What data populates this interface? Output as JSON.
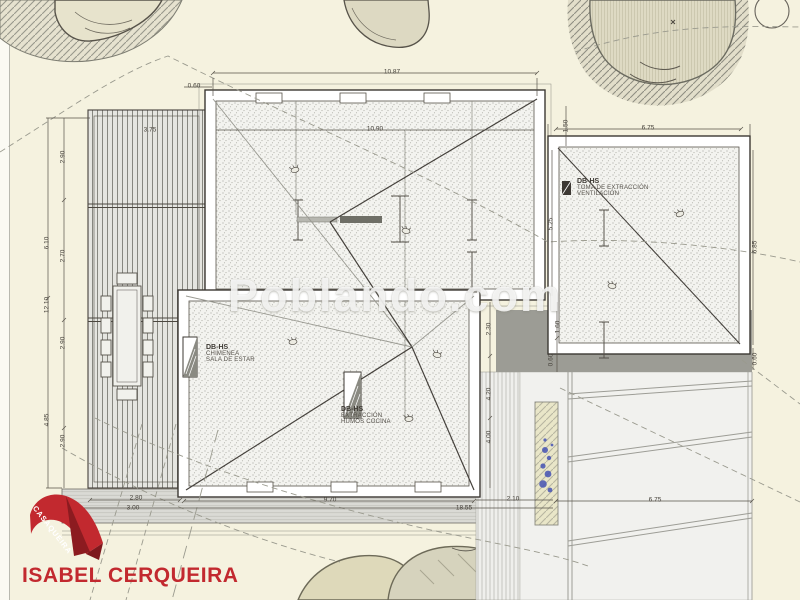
{
  "watermark": "Poblando.com",
  "logo": {
    "ribbon_text": "CASAQUEIRA",
    "name": "ISABEL CERQUEIRA",
    "red": "#c2292f"
  },
  "notes": {
    "intake": {
      "code": "DB-HS",
      "line1": "TOMA DE EXTRACCIÓN",
      "line2": "VENTILACIÓN"
    },
    "chimney": {
      "code": "DB-HS",
      "line1": "CHIMENEA",
      "line2": "SALA DE ESTAR"
    },
    "kitchen": {
      "code": "DB-HS",
      "line1": "EXTRACCIÓN",
      "line2": "HUMOS COCINA"
    }
  },
  "dimensions": [
    {
      "label": "0.60",
      "x": 194,
      "y": 86,
      "rot": 0
    },
    {
      "label": "10.87",
      "x": 392,
      "y": 72,
      "rot": 0
    },
    {
      "label": "10.90",
      "x": 375,
      "y": 129,
      "rot": 0
    },
    {
      "label": "6.75",
      "x": 648,
      "y": 128,
      "rot": 0
    },
    {
      "label": "1.50",
      "x": 566,
      "y": 126,
      "rot": -90
    },
    {
      "label": "5.25",
      "x": 551,
      "y": 224,
      "rot": -90
    },
    {
      "label": "6.85",
      "x": 755,
      "y": 247,
      "rot": -90
    },
    {
      "label": "0.60",
      "x": 755,
      "y": 359,
      "rot": -90
    },
    {
      "label": "3.75",
      "x": 150,
      "y": 130,
      "rot": 0
    },
    {
      "label": "2.90",
      "x": 63,
      "y": 157,
      "rot": -90
    },
    {
      "label": "6.10",
      "x": 47,
      "y": 243,
      "rot": -90
    },
    {
      "label": "2.70",
      "x": 63,
      "y": 256,
      "rot": -90
    },
    {
      "label": "12.10",
      "x": 47,
      "y": 305,
      "rot": -90
    },
    {
      "label": "2.90",
      "x": 63,
      "y": 343,
      "rot": -90
    },
    {
      "label": "4.85",
      "x": 47,
      "y": 420,
      "rot": -90
    },
    {
      "label": "2.90",
      "x": 63,
      "y": 441,
      "rot": -90
    },
    {
      "label": "2.30",
      "x": 489,
      "y": 329,
      "rot": -90
    },
    {
      "label": "1.60",
      "x": 558,
      "y": 327,
      "rot": -90
    },
    {
      "label": "0.60",
      "x": 551,
      "y": 360,
      "rot": -90
    },
    {
      "label": "4.20",
      "x": 489,
      "y": 394,
      "rot": -90
    },
    {
      "label": "4.00",
      "x": 489,
      "y": 437,
      "rot": -90
    },
    {
      "label": "2.80",
      "x": 136,
      "y": 498,
      "rot": 0
    },
    {
      "label": "3.00",
      "x": 133,
      "y": 508,
      "rot": 0
    },
    {
      "label": "9.70",
      "x": 330,
      "y": 500,
      "rot": 0
    },
    {
      "label": "18.55",
      "x": 464,
      "y": 508,
      "rot": 0
    },
    {
      "label": "2.10",
      "x": 513,
      "y": 499,
      "rot": 0
    },
    {
      "label": "6.75",
      "x": 655,
      "y": 500,
      "rot": 0
    }
  ]
}
